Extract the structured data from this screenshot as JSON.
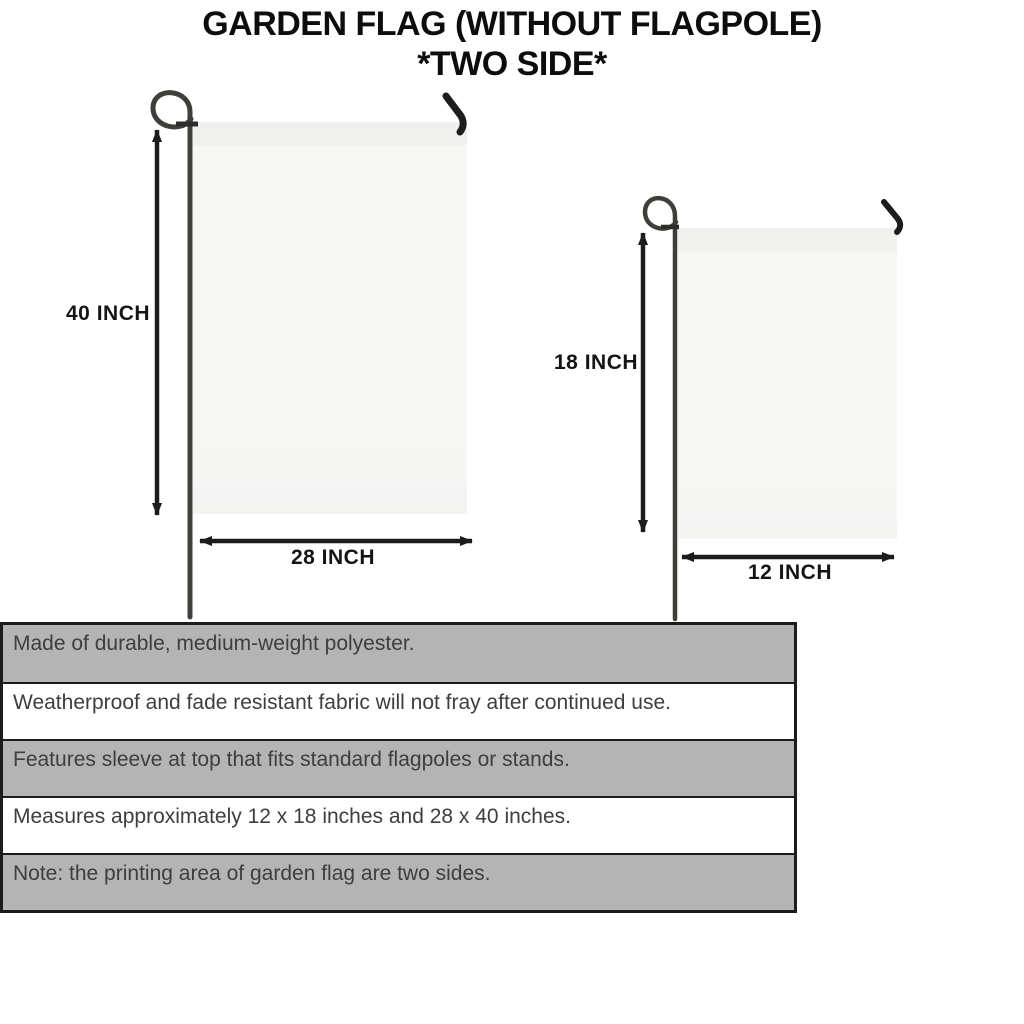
{
  "title": {
    "line1": "GARDEN FLAG (WITHOUT FLAGPOLE)",
    "line2": "*TWO SIDE*"
  },
  "flags": {
    "large": {
      "height_label": "40 INCH",
      "width_label": "28 INCH"
    },
    "small": {
      "height_label": "18 INCH",
      "width_label": "12 INCH"
    }
  },
  "features": {
    "rows": [
      {
        "text": "Made of durable, medium-weight polyester."
      },
      {
        "text": "Weatherproof and fade resistant fabric will not fray after continued use."
      },
      {
        "text": "Features sleeve at top that fits standard flagpoles or stands."
      },
      {
        "text": "Measures approximately 12 x 18 inches and 28 x 40 inches."
      },
      {
        "text": "Note: the printing area of garden flag are two sides."
      }
    ]
  },
  "colors": {
    "row_gray": "#b4b4b4",
    "table_border": "#1c1c1c",
    "flag_fill": "#f6f6f5",
    "pole": "#403e39",
    "hook": "#1d1d1d",
    "arrow": "#1c1c1c",
    "title_ink": "#0d0d0d",
    "table_text": "#3e3e3e"
  }
}
